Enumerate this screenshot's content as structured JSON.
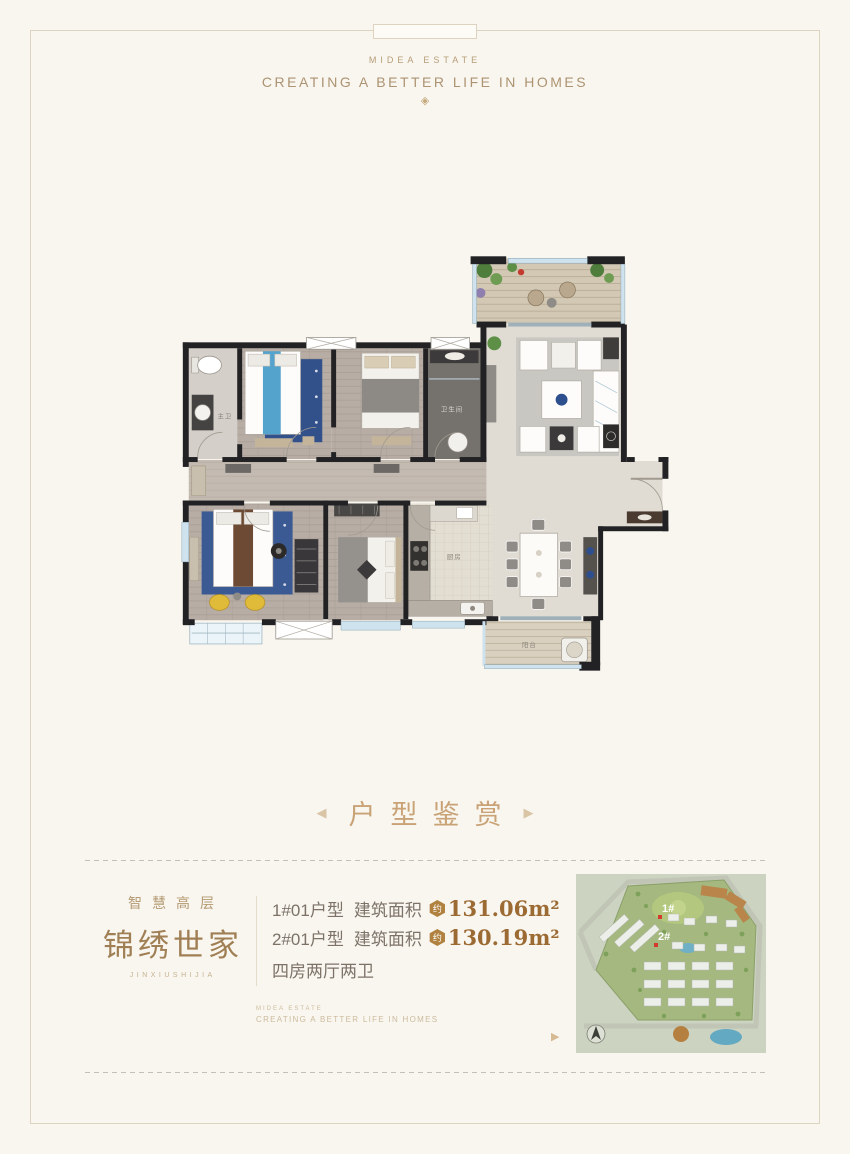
{
  "header": {
    "brand": "MIDEA ESTATE",
    "slogan": "CREATING A BETTER LIFE IN HOMES",
    "ornament_icon": "◈"
  },
  "section": {
    "title": "户型鉴赏",
    "arrow_left_icon": "◀",
    "arrow_right_icon": "▶"
  },
  "floorplan": {
    "labels": {
      "master_bath": "主卫",
      "bath": "卫生间",
      "kitchen": "厨房",
      "balcony": "阳台"
    }
  },
  "branding": {
    "subtitle": "智慧高层",
    "title": "锦绣世家",
    "latin": "JINXIUSHIJIA",
    "mini_brand": "MIDEA ESTATE",
    "mini_slogan": "CREATING A BETTER LIFE IN HOMES"
  },
  "units": {
    "rows": [
      {
        "name": "1#01户型",
        "area_label": "建筑面积",
        "badge": "约",
        "value": "131.06m²"
      },
      {
        "name": "2#01户型",
        "area_label": "建筑面积",
        "badge": "约",
        "value": "130.19m²"
      }
    ],
    "layout": "四房两厅两卫"
  },
  "sitemap": {
    "marker1": "1#",
    "marker2": "2#",
    "arrow_icon": "▶"
  },
  "colors": {
    "accent": "#c9a276",
    "number": "#9c6a33",
    "badge": "#b0813f",
    "page_background": "#f8f6ef",
    "frame_border": "#ddd3c0",
    "wall": "#222225",
    "marker_red": "#d23b2e"
  }
}
